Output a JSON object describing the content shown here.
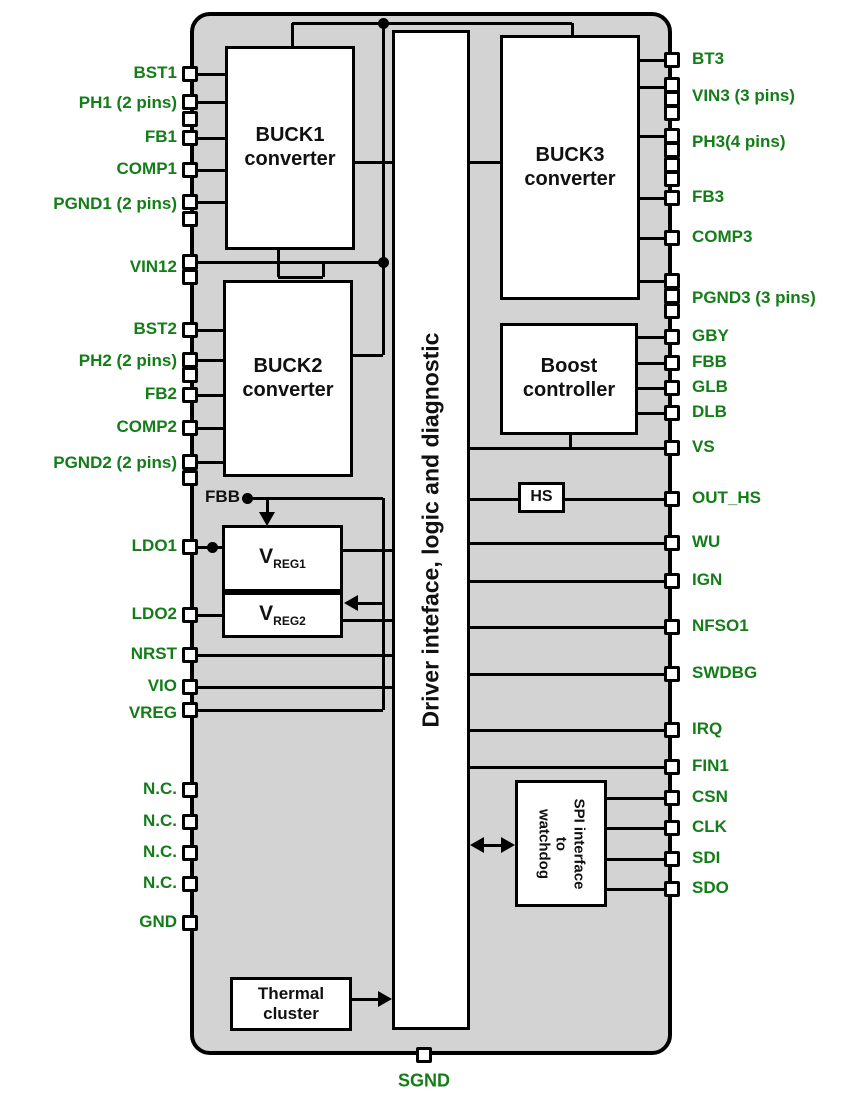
{
  "figure": {
    "name": "IC block diagram",
    "bottom_pin_label": "SGND"
  },
  "colors": {
    "chip_fill": "#d3d3d3",
    "line": "#000000",
    "pin_label_green": "#147d19",
    "block_fill": "#ffffff"
  },
  "chip": {
    "x": 190,
    "y": 12,
    "w": 482,
    "h": 1043
  },
  "style": {
    "wire_px": 3,
    "left_label_right_edge": 177,
    "right_label_left_edge": 692
  },
  "blocks": [
    {
      "id": "buck1",
      "x": 225,
      "y": 46,
      "w": 130,
      "h": 204,
      "lines": [
        "BUCK1",
        "converter"
      ],
      "font": 20
    },
    {
      "id": "buck2",
      "x": 223,
      "y": 280,
      "w": 130,
      "h": 197,
      "lines": [
        "BUCK2",
        "converter"
      ],
      "font": 20
    },
    {
      "id": "buck3",
      "x": 500,
      "y": 35,
      "w": 140,
      "h": 265,
      "lines": [
        "BUCK3",
        "converter"
      ],
      "font": 20
    },
    {
      "id": "boost",
      "x": 500,
      "y": 323,
      "w": 138,
      "h": 112,
      "lines": [
        "Boost",
        "controller"
      ],
      "font": 20
    },
    {
      "id": "driver",
      "x": 392,
      "y": 30,
      "w": 78,
      "h": 1000,
      "lines": [
        "Driver inteface, logic and diagnostic"
      ],
      "font": 23,
      "rotate": -90
    },
    {
      "id": "hs",
      "x": 518,
      "y": 482,
      "w": 47,
      "h": 31,
      "lines": [
        "HS"
      ],
      "font": 16
    },
    {
      "id": "vreg1",
      "x": 222,
      "y": 525,
      "w": 121,
      "h": 67,
      "main": "V",
      "sub": "REG1",
      "font": 21
    },
    {
      "id": "vreg2",
      "x": 222,
      "y": 592,
      "w": 121,
      "h": 46,
      "main": "V",
      "sub": "REG2",
      "font": 21
    },
    {
      "id": "spi",
      "x": 515,
      "y": 780,
      "w": 92,
      "h": 127,
      "lines": [
        "SPI interface",
        "to",
        "watchdog"
      ],
      "font": 15,
      "rotate": 90
    },
    {
      "id": "thermal",
      "x": 230,
      "y": 977,
      "w": 122,
      "h": 54,
      "lines": [
        "Thermal",
        "cluster"
      ],
      "font": 17
    }
  ],
  "pins": {
    "left": [
      {
        "label": "BST1",
        "y": 74,
        "boxes": [
          74
        ]
      },
      {
        "label": "PH1 (2 pins)",
        "y": 104,
        "boxes": [
          102,
          119
        ]
      },
      {
        "label": "FB1",
        "y": 138,
        "boxes": [
          138
        ]
      },
      {
        "label": "COMP1",
        "y": 170,
        "boxes": [
          170
        ]
      },
      {
        "label": "PGND1 (2 pins)",
        "y": 205,
        "boxes": [
          202,
          219
        ]
      },
      {
        "label": "VIN12",
        "y": 268,
        "boxes": [
          262,
          277
        ]
      },
      {
        "label": "BST2",
        "y": 330,
        "boxes": [
          330
        ]
      },
      {
        "label": "PH2 (2 pins)",
        "y": 362,
        "boxes": [
          360,
          375
        ]
      },
      {
        "label": "FB2",
        "y": 395,
        "boxes": [
          395
        ]
      },
      {
        "label": "COMP2",
        "y": 428,
        "boxes": [
          428
        ]
      },
      {
        "label": "PGND2 (2 pins)",
        "y": 464,
        "boxes": [
          462,
          478
        ]
      },
      {
        "label": "LDO1",
        "y": 547,
        "boxes": [
          547
        ]
      },
      {
        "label": "LDO2",
        "y": 615,
        "boxes": [
          615
        ]
      },
      {
        "label": "NRST",
        "y": 655,
        "boxes": [
          655
        ]
      },
      {
        "label": "VIO",
        "y": 687,
        "boxes": [
          687
        ]
      },
      {
        "label": "VREG",
        "y": 714,
        "boxes": [
          710
        ]
      },
      {
        "label": "N.C.",
        "y": 790,
        "boxes": [
          790
        ]
      },
      {
        "label": "N.C.",
        "y": 822,
        "boxes": [
          822
        ]
      },
      {
        "label": "N.C.",
        "y": 853,
        "boxes": [
          853
        ]
      },
      {
        "label": "N.C.",
        "y": 884,
        "boxes": [
          884
        ]
      },
      {
        "label": "GND",
        "y": 923,
        "boxes": [
          923
        ]
      }
    ],
    "right": [
      {
        "label": "BT3",
        "y": 60,
        "boxes": [
          60
        ]
      },
      {
        "label": "VIN3 (3 pins)",
        "y": 97,
        "boxes": [
          85,
          99,
          113
        ]
      },
      {
        "label": "PH3(4 pins)",
        "y": 143,
        "boxes": [
          136,
          150,
          165,
          179
        ]
      },
      {
        "label": "FB3",
        "y": 198,
        "boxes": [
          198
        ]
      },
      {
        "label": "COMP3",
        "y": 238,
        "boxes": [
          238
        ]
      },
      {
        "label": "PGND3 (3 pins)",
        "y": 299,
        "boxes": [
          281,
          296,
          311
        ]
      },
      {
        "label": "GBY",
        "y": 337,
        "boxes": [
          337
        ]
      },
      {
        "label": "FBB",
        "y": 363,
        "boxes": [
          363
        ]
      },
      {
        "label": "GLB",
        "y": 388,
        "boxes": [
          388
        ]
      },
      {
        "label": "DLB",
        "y": 413,
        "boxes": [
          413
        ]
      },
      {
        "label": "VS",
        "y": 448,
        "boxes": [
          448
        ]
      },
      {
        "label": "OUT_HS",
        "y": 499,
        "boxes": [
          499
        ]
      },
      {
        "label": "WU",
        "y": 543,
        "boxes": [
          543
        ]
      },
      {
        "label": "IGN",
        "y": 581,
        "boxes": [
          581
        ]
      },
      {
        "label": "NFSO1",
        "y": 627,
        "boxes": [
          627
        ]
      },
      {
        "label": "SWDBG",
        "y": 674,
        "boxes": [
          674
        ]
      },
      {
        "label": "IRQ",
        "y": 730,
        "boxes": [
          730
        ]
      },
      {
        "label": "FIN1",
        "y": 767,
        "boxes": [
          767
        ]
      },
      {
        "label": "CSN",
        "y": 798,
        "boxes": [
          798
        ]
      },
      {
        "label": "CLK",
        "y": 828,
        "boxes": [
          828
        ]
      },
      {
        "label": "SDI",
        "y": 859,
        "boxes": [
          859
        ]
      },
      {
        "label": "SDO",
        "y": 889,
        "boxes": [
          889
        ]
      }
    ],
    "bottom": [
      {
        "label": "SGND",
        "x": 424,
        "label_y": 1082
      }
    ]
  },
  "inner_labels": [
    {
      "text": "FBB",
      "right_x": 240,
      "y": 498
    }
  ],
  "wires": [
    [
      197,
      74,
      225,
      74
    ],
    [
      197,
      102,
      225,
      102
    ],
    [
      197,
      138,
      225,
      138
    ],
    [
      197,
      170,
      225,
      170
    ],
    [
      197,
      202,
      225,
      202
    ],
    [
      197,
      262,
      383,
      262
    ],
    [
      278,
      250,
      278,
      277
    ],
    [
      278,
      277,
      323,
      277
    ],
    [
      323,
      262,
      323,
      277
    ],
    [
      197,
      330,
      223,
      330
    ],
    [
      197,
      360,
      223,
      360
    ],
    [
      197,
      395,
      223,
      395
    ],
    [
      197,
      428,
      223,
      428
    ],
    [
      197,
      462,
      223,
      462
    ],
    [
      197,
      547,
      222,
      547
    ],
    [
      197,
      615,
      222,
      615
    ],
    [
      197,
      655,
      392,
      655
    ],
    [
      197,
      687,
      392,
      687
    ],
    [
      197,
      710,
      383,
      710
    ],
    [
      247,
      498,
      383,
      498
    ],
    [
      383,
      498,
      383,
      710
    ],
    [
      350,
      603,
      383,
      603
    ],
    [
      267,
      498,
      267,
      522
    ],
    [
      343,
      550,
      392,
      550
    ],
    [
      343,
      620,
      392,
      620
    ],
    [
      292,
      23,
      572,
      23
    ],
    [
      292,
      23,
      292,
      46
    ],
    [
      572,
      23,
      572,
      35
    ],
    [
      383,
      23,
      383,
      355
    ],
    [
      353,
      355,
      383,
      355
    ],
    [
      355,
      162,
      392,
      162
    ],
    [
      470,
      162,
      500,
      162
    ],
    [
      640,
      60,
      665,
      60
    ],
    [
      640,
      87,
      665,
      87
    ],
    [
      640,
      136,
      665,
      136
    ],
    [
      640,
      198,
      665,
      198
    ],
    [
      640,
      238,
      665,
      238
    ],
    [
      640,
      281,
      665,
      281
    ],
    [
      638,
      337,
      665,
      337
    ],
    [
      638,
      363,
      665,
      363
    ],
    [
      638,
      388,
      665,
      388
    ],
    [
      638,
      413,
      665,
      413
    ],
    [
      470,
      448,
      665,
      448
    ],
    [
      570,
      435,
      570,
      448
    ],
    [
      470,
      499,
      518,
      499
    ],
    [
      565,
      499,
      665,
      499
    ],
    [
      470,
      543,
      665,
      543
    ],
    [
      470,
      581,
      665,
      581
    ],
    [
      470,
      627,
      665,
      627
    ],
    [
      470,
      674,
      665,
      674
    ],
    [
      470,
      730,
      665,
      730
    ],
    [
      470,
      767,
      665,
      767
    ],
    [
      607,
      798,
      665,
      798
    ],
    [
      607,
      828,
      665,
      828
    ],
    [
      607,
      859,
      665,
      859
    ],
    [
      607,
      889,
      665,
      889
    ],
    [
      352,
      999,
      386,
      999
    ],
    [
      477,
      845,
      509,
      845
    ]
  ],
  "dots": [
    [
      383,
      23
    ],
    [
      383,
      262
    ],
    [
      247,
      498
    ],
    [
      212,
      547
    ]
  ],
  "arrows": [
    {
      "dir": "down",
      "x": 267,
      "y": 526
    },
    {
      "dir": "left",
      "x": 344,
      "y": 603
    },
    {
      "dir": "right",
      "x": 392,
      "y": 999
    },
    {
      "dir": "left",
      "x": 470,
      "y": 845
    },
    {
      "dir": "right",
      "x": 515,
      "y": 845
    }
  ]
}
